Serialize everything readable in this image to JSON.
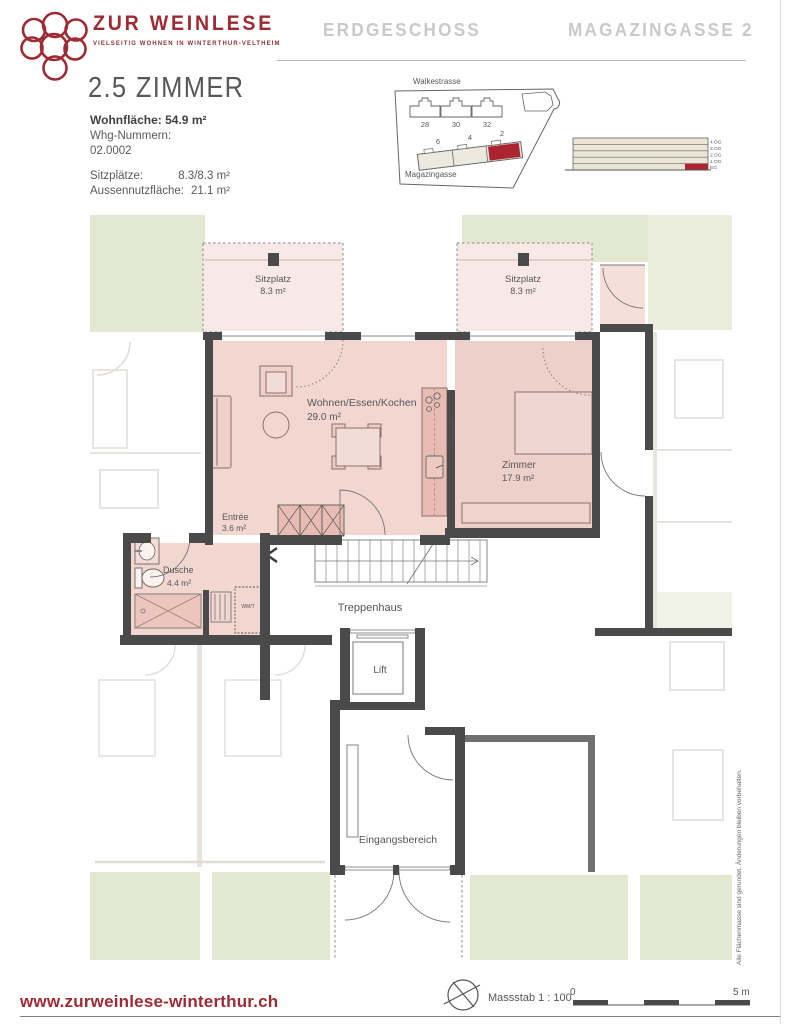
{
  "colors": {
    "brand_red": "#9e2a33",
    "highlight_red": "#ab2430",
    "header_gray": "#c9c9c9",
    "wall_dark": "#4a4a4b",
    "room_pink": "#f2d6d0",
    "terrace_pink": "#f8e9e6",
    "fixture_pink": "#e9bcb3",
    "garden_green": "#e3e8d2"
  },
  "header": {
    "brand_title": "ZUR WEINLESE",
    "brand_subtitle": "VIELSEITIG WOHNEN IN WINTERTHUR-VELTHEIM",
    "floor_title": "ERDGESCHOSS",
    "address_title": "MAGAZINGASSE 2"
  },
  "info": {
    "apartment_title": "2.5 ZIMMER",
    "living_area_label": "Wohnfläche:",
    "living_area_value": "54.9 m²",
    "unit_numbers_label": "Whg-Nummern:",
    "unit_number": "02.0002",
    "details": [
      {
        "label": "Sitzplätze:",
        "value": "8.3/8.3 m²"
      },
      {
        "label": "Aussennutzfläche:",
        "value": "21.1 m²"
      }
    ]
  },
  "site_plan": {
    "street_top": "Walkestrasse",
    "street_bottom": "Magazingasse",
    "houses_top": [
      "28",
      "30",
      "32"
    ],
    "houses_bottom": [
      "6",
      "4",
      "2"
    ],
    "highlighted_house": "2"
  },
  "elevation": {
    "floors": [
      "4.OG",
      "3.OG",
      "2.OG",
      "1.OG",
      "EG"
    ],
    "highlighted_floor": "EG"
  },
  "floor_plan": {
    "rooms": {
      "sitzplatz_left": {
        "name": "Sitzplatz",
        "area": "8.3 m²"
      },
      "sitzplatz_right": {
        "name": "Sitzplatz",
        "area": "8.3 m²"
      },
      "wohnen": {
        "name": "Wohnen/Essen/Kochen",
        "area": "29.0 m²"
      },
      "zimmer": {
        "name": "Zimmer",
        "area": "17.9 m²"
      },
      "entree": {
        "name": "Entrée",
        "area": "3.6 m²"
      },
      "dusche": {
        "name": "Dusche",
        "area": "4.4 m²"
      },
      "treppenhaus": {
        "name": "Treppenhaus"
      },
      "lift": {
        "name": "Lift"
      },
      "eingang": {
        "name": "Eingangsbereich"
      }
    },
    "annotations": {
      "sliding_door": "Schiebetür",
      "washer": "WM/T"
    }
  },
  "footer": {
    "website": "www.zurweinlese-winterthur.ch",
    "scale_label": "Massstab 1 : 100",
    "scale_zero": "0",
    "scale_max": "5 m"
  },
  "side_note": "Alle Flächenmasse sind gerundet. Änderungen bleiben vorbehalten."
}
